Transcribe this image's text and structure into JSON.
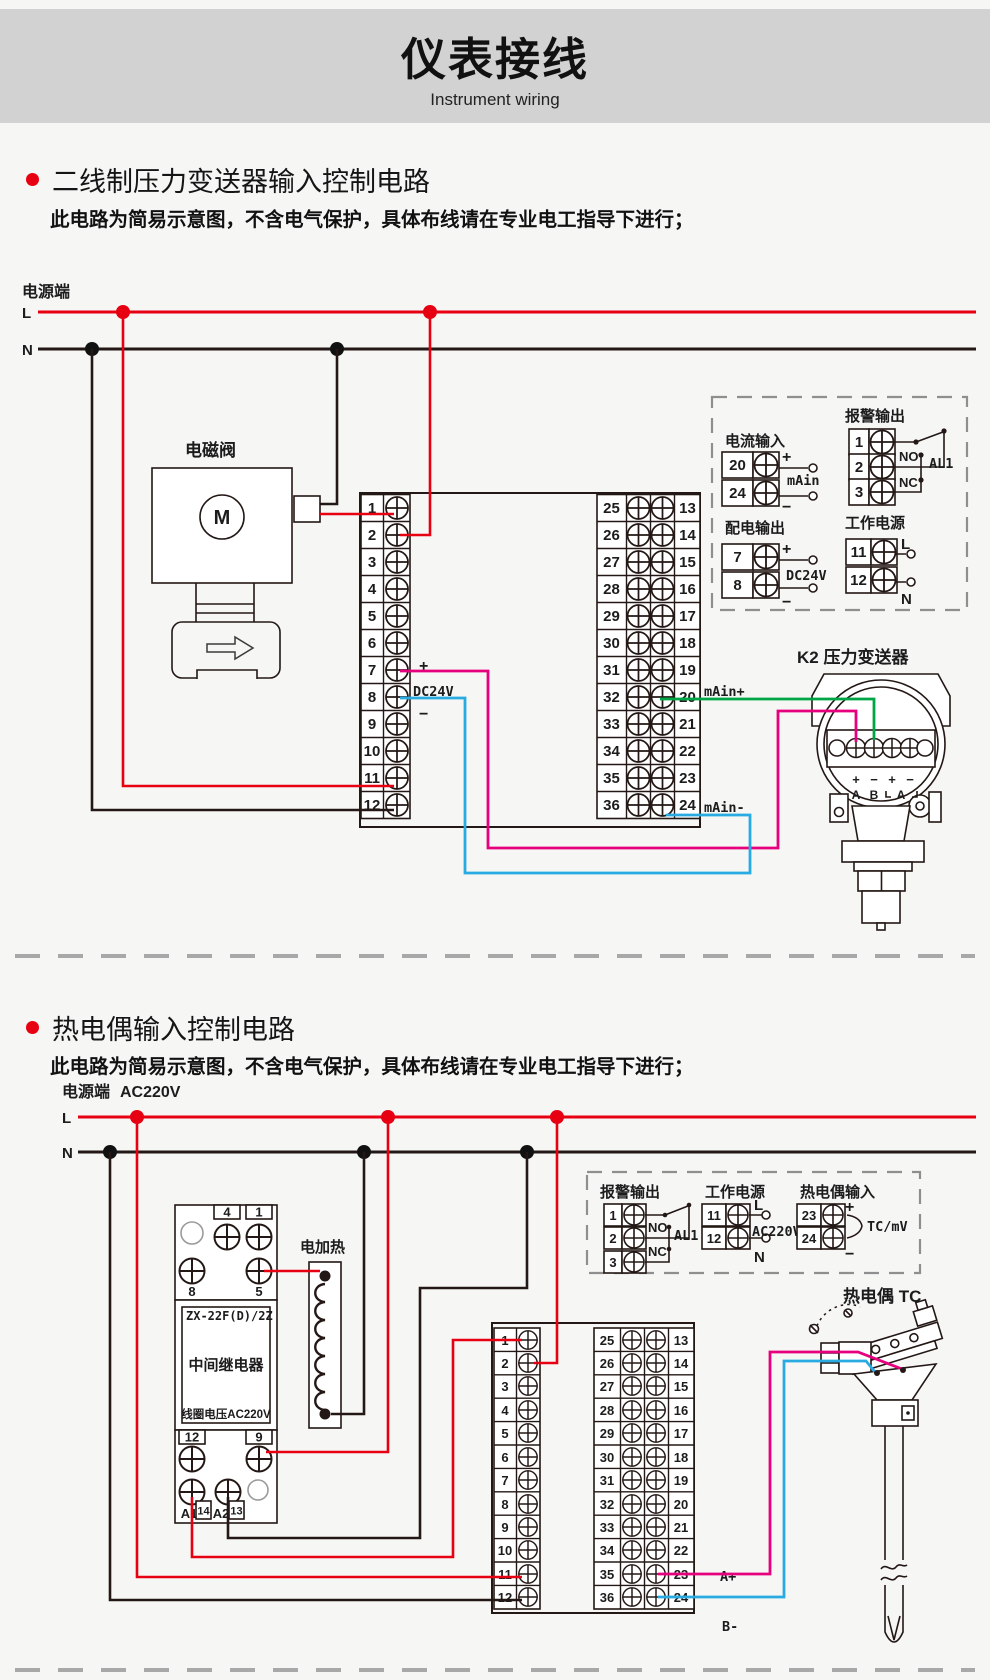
{
  "header": {
    "title": "仪表接线",
    "subtitle": "Instrument wiring"
  },
  "sections": [
    {
      "title": "二线制压力变送器输入控制电路",
      "note": "此电路为简易示意图，不含电气保护，具体布线请在专业电工指导下进行；"
    },
    {
      "title": "热电偶输入控制电路",
      "note": "此电路为简易示意图，不含电气保护，具体布线请在专业电工指导下进行；"
    }
  ],
  "power": {
    "label": "电源端",
    "l": "L",
    "n": "N",
    "ac": "AC220V"
  },
  "instrument": {
    "left": [
      "1",
      "2",
      "3",
      "4",
      "5",
      "6",
      "7",
      "8",
      "9",
      "10",
      "11",
      "12"
    ],
    "mid": [
      "25",
      "26",
      "27",
      "28",
      "29",
      "30",
      "31",
      "32",
      "33",
      "34",
      "35",
      "36"
    ],
    "right": [
      "13",
      "14",
      "15",
      "16",
      "17",
      "18",
      "19",
      "20",
      "21",
      "22",
      "23",
      "24"
    ]
  },
  "d1": {
    "solenoid": "电磁阀",
    "motor": "M",
    "plus": "+",
    "minus": "−",
    "dc24v": "DC24V",
    "main_plus": "mAin+",
    "main_minus": "mAin-",
    "transmitter": "K2  压力变送器",
    "tx_polarity": [
      "+",
      "−",
      "+",
      "−"
    ],
    "tx_groups": [
      "A",
      "B",
      "A"
    ],
    "box": {
      "current": {
        "title": "电流输入",
        "a": "20",
        "b": "24",
        "plus": "+",
        "minus": "−",
        "label": "mAin"
      },
      "alarm": {
        "title": "报警输出",
        "a": "1",
        "b": "2",
        "c": "3",
        "no": "NO",
        "nc": "NC",
        "label": "AL1"
      },
      "dist": {
        "title": "配电输出",
        "a": "7",
        "b": "8",
        "plus": "+",
        "minus": "−",
        "label": "DC24V"
      },
      "work": {
        "title": "工作电源",
        "a": "11",
        "b": "12",
        "l": "L",
        "n": "N"
      }
    }
  },
  "d2": {
    "relay": {
      "model": "ZX-22F(D)/2Z",
      "name": "中间继电器",
      "coil": "线圈电压AC220V",
      "t4": "4",
      "t1": "1",
      "t8": "8",
      "t5": "5",
      "t12": "12",
      "t9": "9",
      "a1": "A1",
      "n14": "14",
      "a2": "A2",
      "n13": "13"
    },
    "heater": "电加热",
    "tc": "热电偶 TC",
    "a_plus": "A+",
    "b_minus": "B-",
    "box": {
      "alarm": {
        "title": "报警输出",
        "a": "1",
        "b": "2",
        "c": "3",
        "no": "NO",
        "nc": "NC",
        "label": "AL1"
      },
      "work": {
        "title": "工作电源",
        "a": "11",
        "b": "12",
        "l": "L",
        "n": "N",
        "label": "AC220V"
      },
      "tc": {
        "title": "热电偶输入",
        "a": "23",
        "b": "24",
        "plus": "+",
        "minus": "−",
        "label": "TC/mV"
      }
    }
  },
  "colors": {
    "accent_red": "#e60012",
    "wire_green": "#00a546",
    "wire_blue": "#29abe2",
    "wire_magenta": "#e6007e",
    "band_gray": "#d2d2d2",
    "ink": "#231815"
  }
}
